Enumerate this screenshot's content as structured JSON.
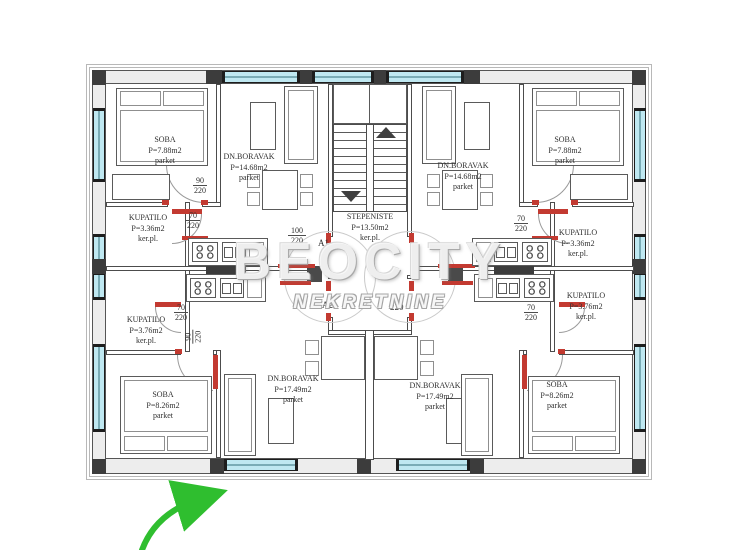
{
  "watermark": {
    "brand": "BEOCITY",
    "subtitle": "NEKRETNINE"
  },
  "rooms": [
    {
      "id": "soba-top-left",
      "name": "SOBA",
      "area": "P=7.88m2",
      "floor": "parket"
    },
    {
      "id": "dnboravak-top-left",
      "name": "DN.BORAVAK",
      "area": "P=14.68m2",
      "floor": "parket"
    },
    {
      "id": "kupatilo-top-left",
      "name": "KUPATILO",
      "area": "P=3.36m2",
      "floor": "ker.pl."
    },
    {
      "id": "stepeniste",
      "name": "STEPENISTE",
      "area": "P=13.50m2",
      "floor": "ker.pl."
    },
    {
      "id": "soba-top-right",
      "name": "SOBA",
      "area": "P=7.88m2",
      "floor": "parket"
    },
    {
      "id": "dnboravak-top-right",
      "name": "DN.BORAVAK",
      "area": "P=14.68m2",
      "floor": "parket"
    },
    {
      "id": "kupatilo-top-right",
      "name": "KUPATILO",
      "area": "P=3.36m2",
      "floor": "ker.pl."
    },
    {
      "id": "kupatilo-bot-left",
      "name": "KUPATILO",
      "area": "P=3.76m2",
      "floor": "ker.pl."
    },
    {
      "id": "soba-bot-left",
      "name": "SOBA",
      "area": "P=8.26m2",
      "floor": "parket"
    },
    {
      "id": "dnboravak-bot-left",
      "name": "DN.BORAVAK",
      "area": "P=17.49m2",
      "floor": "parket"
    },
    {
      "id": "kupatilo-bot-right",
      "name": "KUPATILO",
      "area": "P=3.76m2",
      "floor": "ker.pl."
    },
    {
      "id": "soba-bot-right",
      "name": "SOBA",
      "area": "P=8.26m2",
      "floor": "parket"
    },
    {
      "id": "dnboravak-bot-right",
      "name": "DN.BORAVAK",
      "area": "P=17.49m2",
      "floor": "parket"
    }
  ],
  "dims": [
    {
      "w": "90",
      "h": "220"
    },
    {
      "w": "70",
      "h": "220"
    },
    {
      "w": "100",
      "h": "220"
    },
    {
      "w": "70",
      "h": "220"
    },
    {
      "w": "70",
      "h": "220"
    },
    {
      "w": "90",
      "h": "220"
    },
    {
      "w": "70",
      "h": "220"
    }
  ],
  "unit_labels": {
    "a1": "A1",
    "a2": "A2",
    "entry_width": "220"
  },
  "colors": {
    "window": "#bfe8f1",
    "door_red": "#c33a31",
    "arrow_green": "#2fbe2f",
    "wall": "#4c4c4c",
    "watermark_gray": "#cccccc"
  }
}
